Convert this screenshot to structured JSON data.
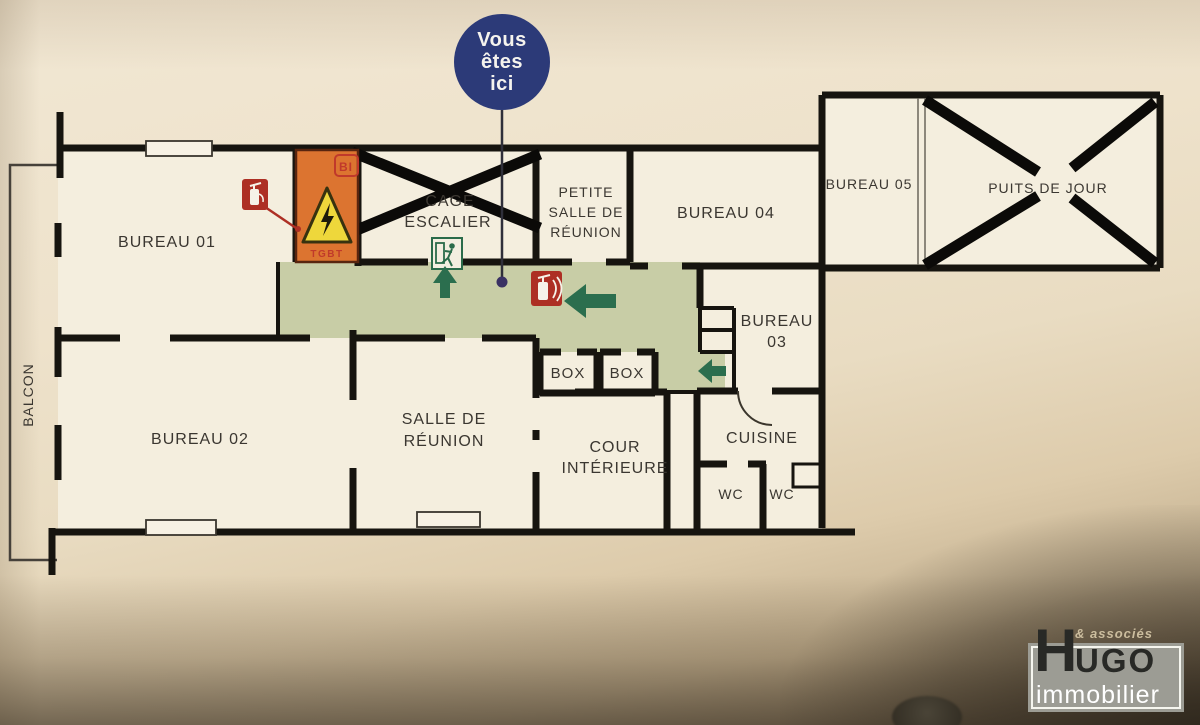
{
  "badge": {
    "line1": "Vous",
    "line2": "êtes",
    "line3": "ici"
  },
  "rooms": {
    "bureau01": {
      "label": "BUREAU 01"
    },
    "bureau02": {
      "label": "BUREAU 02"
    },
    "bureau03": {
      "line1": "BUREAU",
      "line2": "03"
    },
    "bureau04": {
      "label": "BUREAU 04"
    },
    "bureau05": {
      "label": "BUREAU 05"
    },
    "balcon": {
      "label": "BALCON"
    },
    "cage_escalier": {
      "line1": "CAGE",
      "line2": "ESCALIER"
    },
    "petite_salle": {
      "line1": "PETITE",
      "line2": "SALLE DE",
      "line3": "RÉUNION"
    },
    "puits_de_jour": {
      "label": "PUITS DE JOUR"
    },
    "salle_reunion": {
      "line1": "SALLE DE",
      "line2": "RÉUNION"
    },
    "box1": {
      "label": "BOX"
    },
    "box2": {
      "label": "BOX"
    },
    "cour_interieure": {
      "line1": "COUR",
      "line2": "INTÉRIEURE"
    },
    "cuisine": {
      "label": "CUISINE"
    },
    "wc1": {
      "label": "WC"
    },
    "wc2": {
      "label": "WC"
    }
  },
  "markers": {
    "tgbt": "TGBT",
    "bi": "BI"
  },
  "logo": {
    "associes": "& associés",
    "brand_h": "H",
    "brand_rest": "UGO",
    "subtitle": "immobilier"
  },
  "colors": {
    "corridor_green": "#c8cda6",
    "wall_black": "#16140f",
    "badge_blue": "#2c3a78",
    "tgbt_orange": "#dc7430",
    "hazard_yellow": "#eed73b",
    "fire_red": "#ad2f24",
    "exit_green": "#2a6b4a",
    "arrow_green": "#2b6e4e",
    "plan_paper": "#f4eede",
    "logo_grey": "#9c9c94",
    "logo_dark": "#282926",
    "logo_white": "#ffffff"
  }
}
